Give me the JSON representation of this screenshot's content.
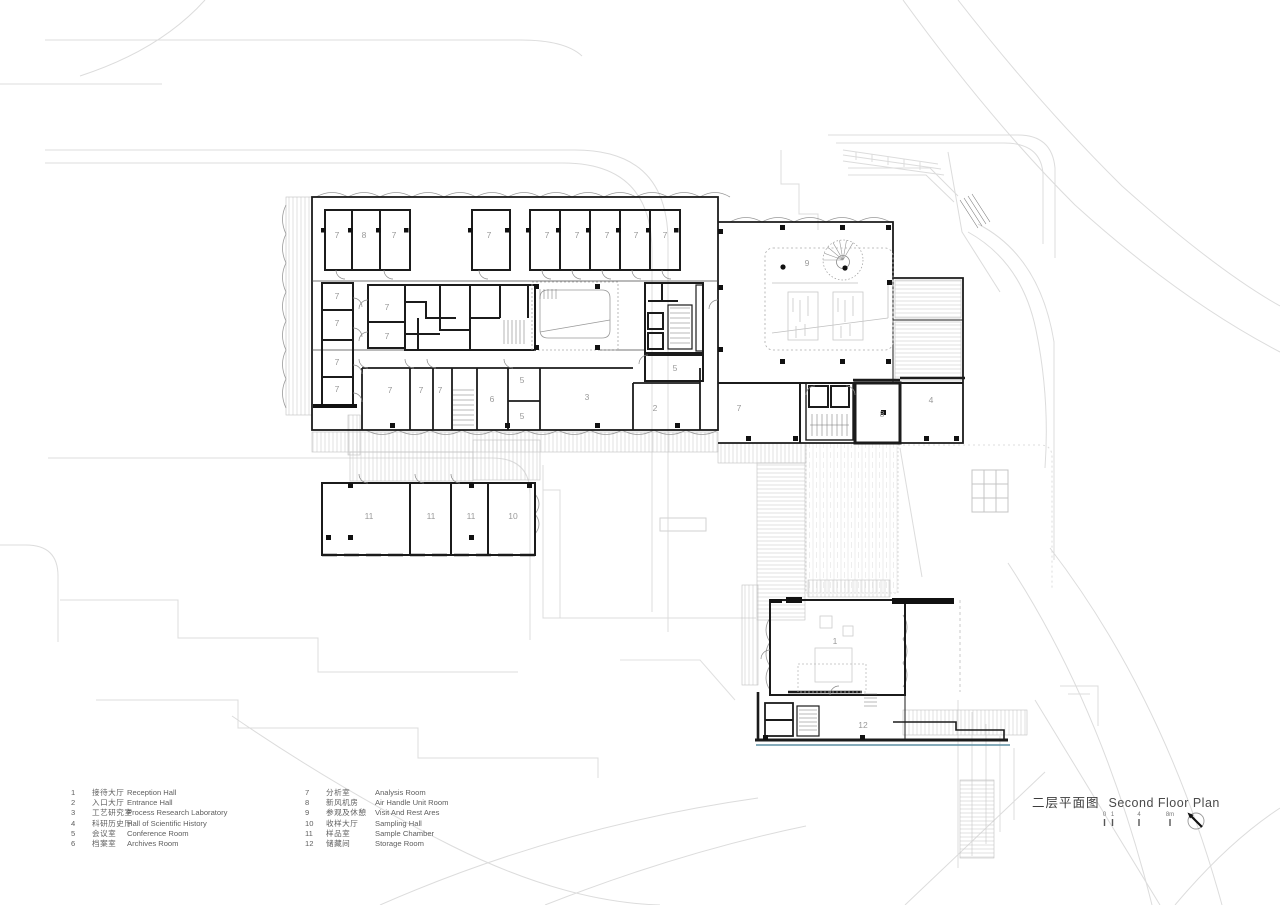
{
  "title": {
    "zh": "二层平面图",
    "en": "Second Floor Plan"
  },
  "scale_bar": {
    "labels": [
      "0",
      "1",
      "4",
      "8m"
    ]
  },
  "legend": {
    "col1": [
      {
        "num": "1",
        "zh": "接待大厅",
        "en": "Reception Hall"
      },
      {
        "num": "2",
        "zh": "入口大厅",
        "en": "Entrance Hall"
      },
      {
        "num": "3",
        "zh": "工艺研究室",
        "en": "Process Research Laboratory"
      },
      {
        "num": "4",
        "zh": "科研历史厅",
        "en": "Hall of Scientific History"
      },
      {
        "num": "5",
        "zh": "会议室",
        "en": "Conference Room"
      },
      {
        "num": "6",
        "zh": "档案室",
        "en": "Archives Room"
      }
    ],
    "col2": [
      {
        "num": "7",
        "zh": "分析室",
        "en": "Analysis Room"
      },
      {
        "num": "8",
        "zh": "新风机房",
        "en": "Air Handle Unit Room"
      },
      {
        "num": "9",
        "zh": "参观及休憩",
        "en": "Visit And Rest Ares"
      },
      {
        "num": "10",
        "zh": "收样大厅",
        "en": "Sampling Hall"
      },
      {
        "num": "11",
        "zh": "样品室",
        "en": "Sample Chamber"
      },
      {
        "num": "12",
        "zh": "储藏间",
        "en": "Storage Room"
      }
    ]
  },
  "colors": {
    "wall": "#1b1b1b",
    "context": "#d9d9d9",
    "label": "#9a9a9a",
    "accent_blue": "#5d8fa3"
  },
  "plan": {
    "room_labels": [
      {
        "t": "7",
        "x": 337,
        "y": 238
      },
      {
        "t": "8",
        "x": 364,
        "y": 238
      },
      {
        "t": "7",
        "x": 394,
        "y": 238
      },
      {
        "t": "7",
        "x": 489,
        "y": 238
      },
      {
        "t": "7",
        "x": 547,
        "y": 238
      },
      {
        "t": "7",
        "x": 577,
        "y": 238
      },
      {
        "t": "7",
        "x": 607,
        "y": 238
      },
      {
        "t": "7",
        "x": 636,
        "y": 238
      },
      {
        "t": "7",
        "x": 665,
        "y": 238
      },
      {
        "t": "7",
        "x": 337,
        "y": 299
      },
      {
        "t": "7",
        "x": 337,
        "y": 326
      },
      {
        "t": "7",
        "x": 337,
        "y": 365
      },
      {
        "t": "7",
        "x": 337,
        "y": 392
      },
      {
        "t": "7",
        "x": 387,
        "y": 310
      },
      {
        "t": "7",
        "x": 387,
        "y": 339
      },
      {
        "t": "7",
        "x": 390,
        "y": 393
      },
      {
        "t": "7",
        "x": 421,
        "y": 393
      },
      {
        "t": "7",
        "x": 440,
        "y": 393
      },
      {
        "t": "6",
        "x": 492,
        "y": 402
      },
      {
        "t": "5",
        "x": 522,
        "y": 383
      },
      {
        "t": "5",
        "x": 522,
        "y": 419
      },
      {
        "t": "3",
        "x": 587,
        "y": 400
      },
      {
        "t": "2",
        "x": 655,
        "y": 411
      },
      {
        "t": "5",
        "x": 675,
        "y": 371
      },
      {
        "t": "9",
        "x": 807,
        "y": 266
      },
      {
        "t": "7",
        "x": 739,
        "y": 411
      },
      {
        "t": "8",
        "x": 882,
        "y": 417
      },
      {
        "t": "4",
        "x": 931,
        "y": 403
      },
      {
        "t": "11",
        "x": 369,
        "y": 519
      },
      {
        "t": "11",
        "x": 431,
        "y": 519
      },
      {
        "t": "11",
        "x": 471,
        "y": 519
      },
      {
        "t": "10",
        "x": 513,
        "y": 519
      },
      {
        "t": "1",
        "x": 835,
        "y": 644
      },
      {
        "t": "12",
        "x": 863,
        "y": 728
      }
    ]
  }
}
